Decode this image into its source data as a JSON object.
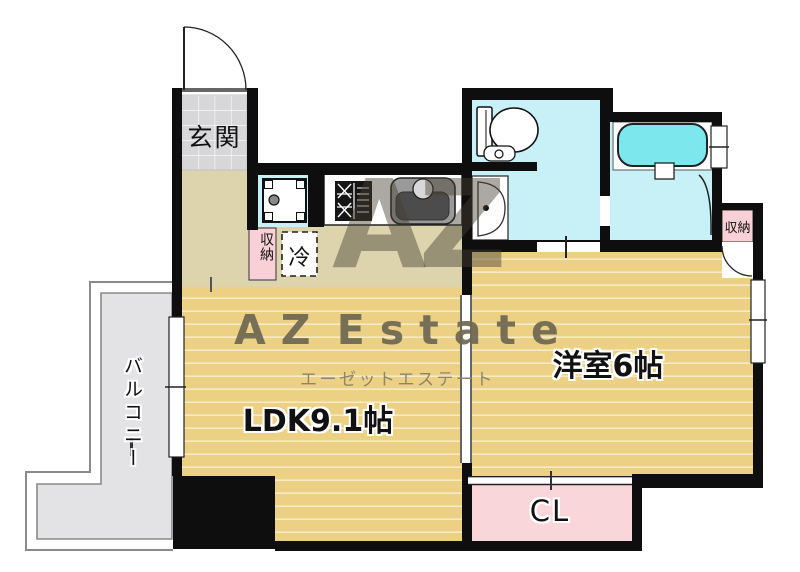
{
  "plan_type": "apartment-floor-plan",
  "rooms": {
    "genkan": {
      "label": "玄関"
    },
    "balcony": {
      "label": "バルコニー"
    },
    "ldk": {
      "label": "LDK9.1帖"
    },
    "western_room": {
      "label": "洋室6帖"
    },
    "closet": {
      "label": "CL"
    },
    "storage_hall": {
      "label": "収納"
    },
    "storage_east": {
      "label": "収納"
    },
    "fridge": {
      "label": "冷"
    }
  },
  "watermark": {
    "monogram": "AZ",
    "brand": "AZ Estate",
    "brand_kana": "エーゼットエステート"
  },
  "colors": {
    "wall": "#0e0e0e",
    "wood_floor": "#ecd083",
    "kitchen_floor": "#ddd4ae",
    "entrance_tile": "#d7d7da",
    "wet_area": "#c7f1f6",
    "bathtub": "#7ce8ee",
    "closet_pink": "#f8d2d8",
    "balcony_gray": "#e3e3e5",
    "watermark_olive": "#6f6852"
  }
}
